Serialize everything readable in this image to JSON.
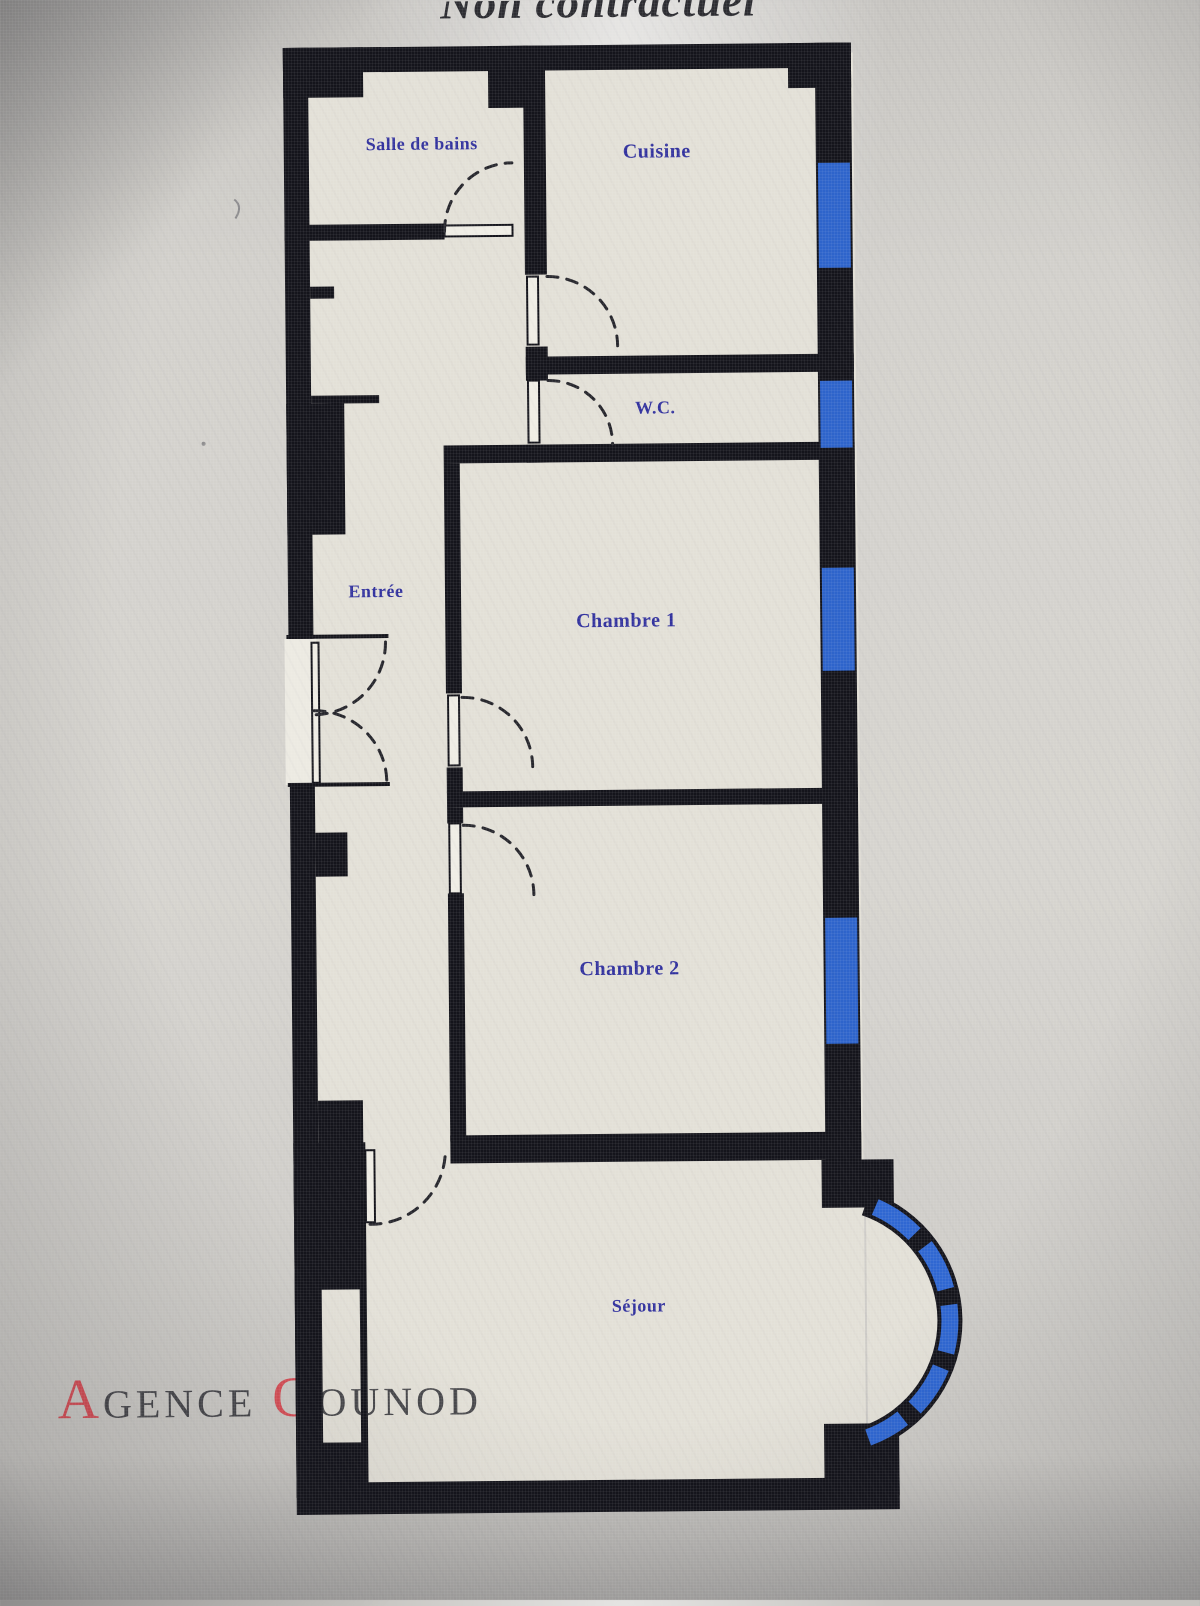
{
  "photo": {
    "top_note": "Non contractuel"
  },
  "floorplan": {
    "rooms": [
      {
        "key": "salle-de-bains",
        "label": "Salle de bains"
      },
      {
        "key": "cuisine",
        "label": "Cuisine"
      },
      {
        "key": "wc",
        "label": "W.C."
      },
      {
        "key": "chambre-1",
        "label": "Chambre 1"
      },
      {
        "key": "entree",
        "label": "Entrée"
      },
      {
        "key": "chambre-2",
        "label": "Chambre 2"
      },
      {
        "key": "sejour",
        "label": "Séjour"
      }
    ],
    "colors": {
      "wall": "#14141b",
      "floor": "#e3e0d7",
      "window_blue": "#2e64cb",
      "room_label_blue": "#32329e",
      "background_gray": "#d3d1cc"
    }
  },
  "watermark": {
    "words": [
      {
        "initial": "A",
        "rest": "GENCE"
      },
      {
        "initial": "G",
        "rest": "OUNOD"
      }
    ],
    "initial_color": "#d8434c",
    "text_color": "#3b3b40"
  }
}
